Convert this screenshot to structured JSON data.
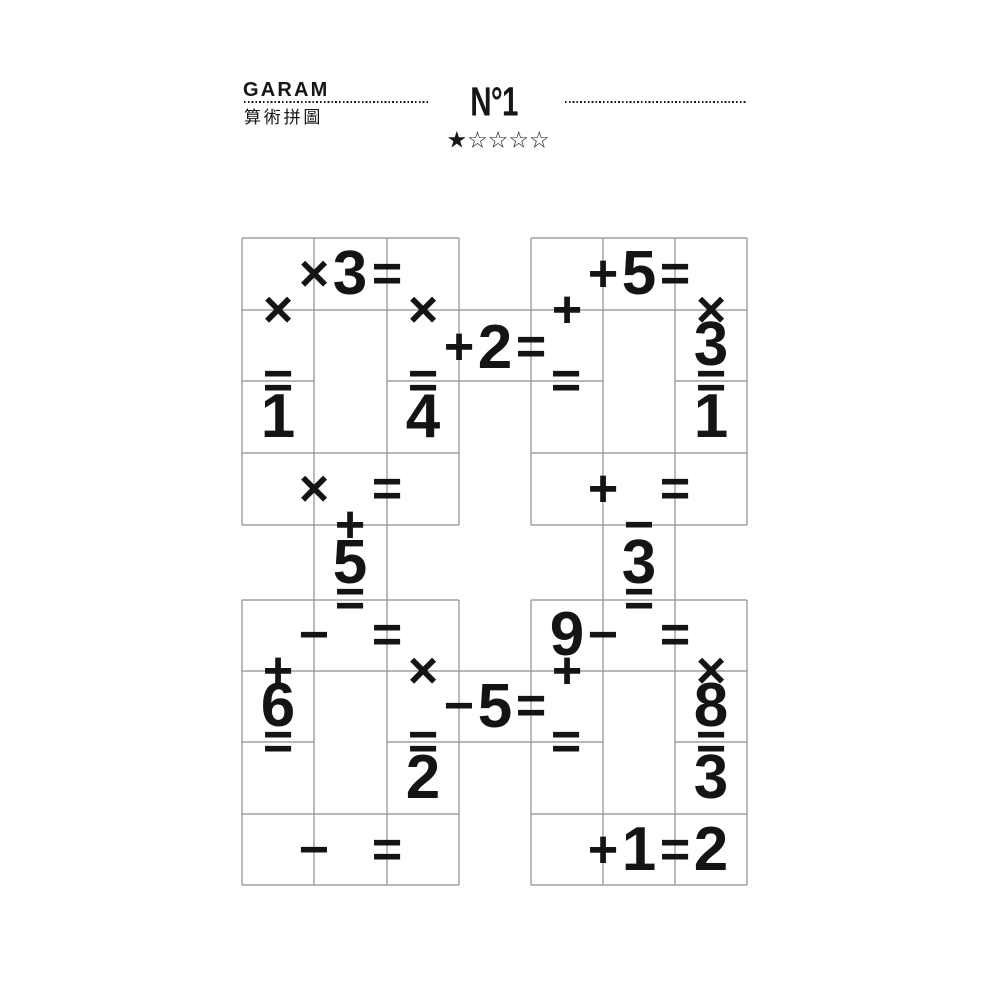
{
  "header": {
    "logo": "GARAM",
    "subtitle": "算術拼圖",
    "puzzle_number": "N°1",
    "difficulty": {
      "level": 1,
      "max": 5,
      "stars": [
        "★",
        "☆",
        "☆",
        "☆",
        "☆"
      ]
    }
  },
  "puzzle": {
    "grid_color": "#8e8e8e",
    "ink_color": "#141414",
    "blocks": {
      "top_left": {
        "row1": {
          "op": "×",
          "b": "3",
          "eq": "="
        },
        "col1": {
          "op": "×",
          "eq": "=",
          "result": "1"
        },
        "col3": {
          "op": "×",
          "eq": "=",
          "result": "4"
        },
        "row4": {
          "op": "×",
          "eq": "="
        }
      },
      "top_right": {
        "row1": {
          "op": "+",
          "b": "5",
          "eq": "="
        },
        "col1": {
          "op": "+",
          "eq": "="
        },
        "col3": {
          "op": "×",
          "b": "3",
          "eq": "=",
          "result": "1"
        },
        "row4": {
          "op": "+",
          "eq": "="
        }
      },
      "bottom_left": {
        "row1": {
          "op": "−",
          "eq": "="
        },
        "col1": {
          "op": "+",
          "b": "6",
          "eq": "="
        },
        "col3": {
          "op": "×",
          "eq": "=",
          "result": "2"
        },
        "row4": {
          "op": "−",
          "eq": "="
        }
      },
      "bottom_right": {
        "row1": {
          "a": "9",
          "op": "−",
          "eq": "="
        },
        "col1": {
          "op": "+",
          "eq": "="
        },
        "col3": {
          "op": "×",
          "b": "8",
          "eq": "=",
          "result": "3"
        },
        "row4": {
          "op": "+",
          "b": "1",
          "eq": "=",
          "result": "2"
        }
      }
    },
    "connectors": {
      "top_middle": {
        "op": "+",
        "value": "2",
        "eq": "="
      },
      "bottom_middle": {
        "op": "−",
        "value": "5",
        "eq": "="
      },
      "left_vertical": {
        "op": "+",
        "value": "5",
        "eq": "="
      },
      "right_vertical": {
        "op": "−",
        "value": "3",
        "eq": "="
      }
    }
  }
}
